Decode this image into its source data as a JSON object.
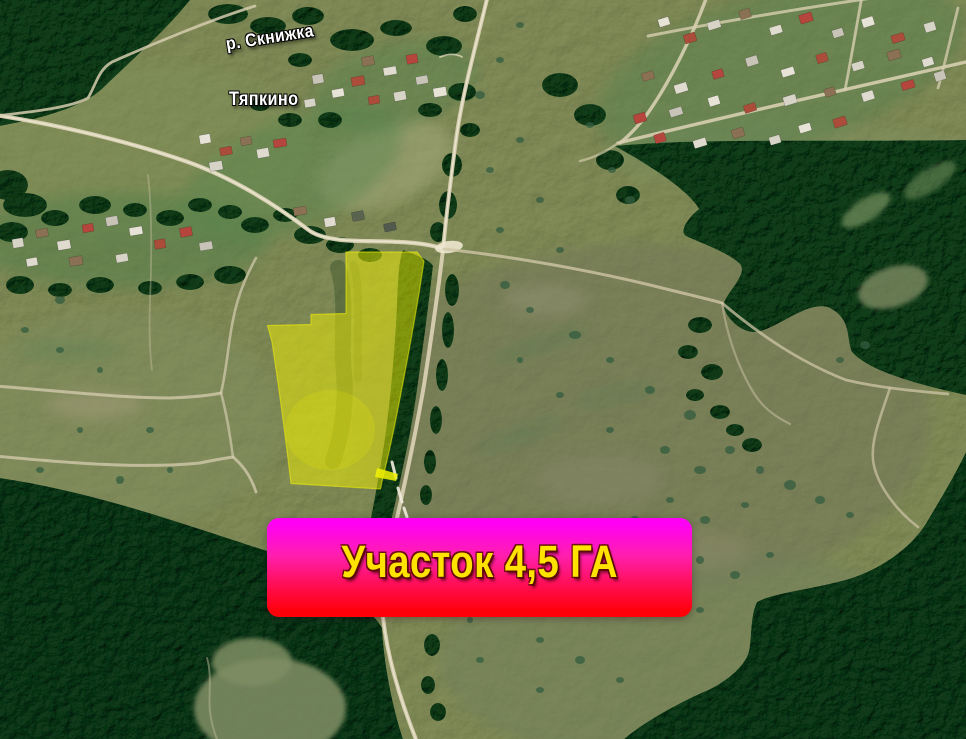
{
  "page": {
    "kind": "satellite-map-promo",
    "width": 966,
    "height": 739
  },
  "map": {
    "labels": {
      "river": "р. Скнижка",
      "village": "Тяпкино"
    }
  },
  "plot": {
    "banner_label": "Участок 4,5 ГА",
    "highlight_color": "#e9e900",
    "banner_gradient_top": "#ff00f4",
    "banner_gradient_bottom": "#ff0008",
    "banner_text_color": "#ffe300",
    "label_text_color": "#ffffff"
  }
}
